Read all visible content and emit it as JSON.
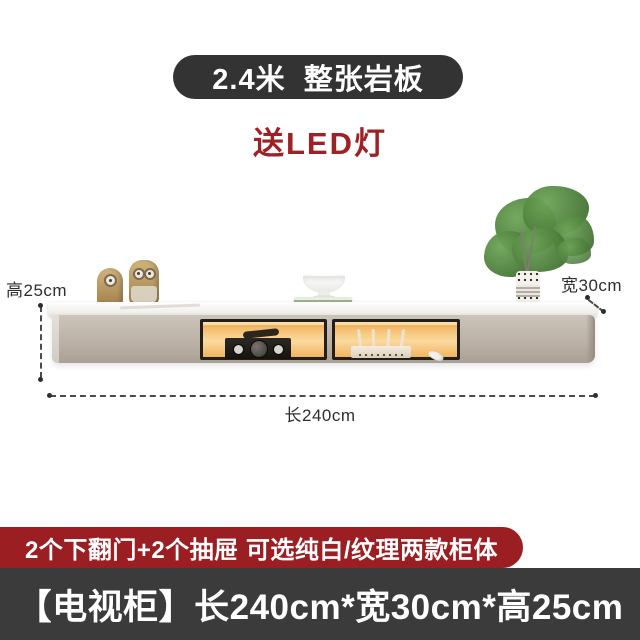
{
  "title_banner": {
    "text": "2.4米  整张岩板",
    "bg_color": "#333333",
    "text_color": "#ffffff"
  },
  "promo_text": {
    "text": "送LED灯",
    "color": "#9e2125"
  },
  "scene": {
    "dimension_labels": {
      "height": "高25cm",
      "width": "宽30cm",
      "length": "长240cm"
    },
    "decor_icons": [
      "minion-figurines-icon",
      "pedestal-bowl-icon",
      "books-icon",
      "green-plant-vase-icon",
      "amplifier-icon",
      "router-icon"
    ],
    "cabinet_colors": {
      "body": "#bdb2a7",
      "top_slab": "#f4f2ee",
      "led_glow": "#f3b766",
      "frame": "#221e1a"
    }
  },
  "feature_banner": {
    "text": "2个下翻门+2个抽屉 可选纯白/纹理两款柜体",
    "bg_color": "#9b1e23",
    "text_color": "#ffffff"
  },
  "spec_banner": {
    "text": "【电视柜】长240cm*宽30cm*高25cm",
    "bg_color": "#3b3b3b",
    "text_color": "#ffffff"
  }
}
